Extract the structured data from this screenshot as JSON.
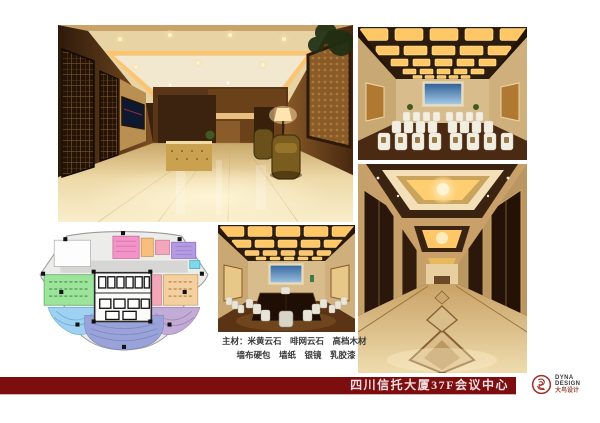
{
  "footer": {
    "title": "四川信托大厦37F会议中心"
  },
  "logo": {
    "line1": "DYNA",
    "line2": "DESIGN",
    "line3": "大鸟设计"
  },
  "materials": {
    "line1": "主材：米黄云石　啡网云石　高档木材",
    "line2": "墙布硬包　墙纸　银镜　乳胶漆"
  },
  "images": {
    "main": "lobby-reception-render",
    "top_right": "conference-hall-render",
    "right": "elevator-corridor-render",
    "center_bottom": "meeting-room-render",
    "plan": "37f-floor-plan"
  },
  "colors": {
    "footer_bar": "#7c0e10",
    "logo_red": "#a03028",
    "render_gold": "#ffc766",
    "render_wood": "#3a2310",
    "plan_green": "#9ce39c",
    "plan_blue": "#9ed2f0",
    "plan_lavender": "#9aa2da",
    "plan_mauve": "#c2abd4",
    "plan_pink": "#f2a8b8",
    "plan_magenta": "#f393c8",
    "plan_orange": "#f7be7e",
    "plan_tan": "#f4cfa0",
    "plan_purple": "#b49ae2",
    "plan_cyan": "#7cd8ea"
  }
}
